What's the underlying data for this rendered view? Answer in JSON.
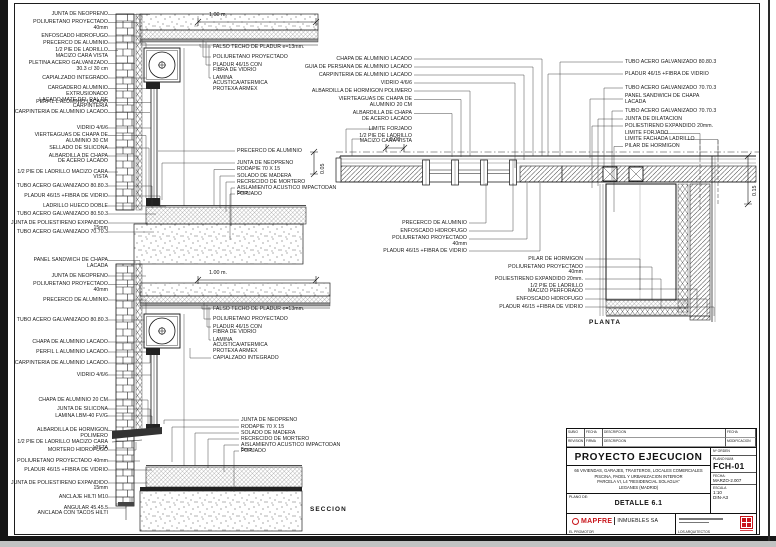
{
  "section": {
    "caption": "SECCION",
    "dim_top": "1.00 m.",
    "dim_mid": "1.00 m.",
    "dim_step": "0.05",
    "labels_a": [
      "JUNTA DE NEOPRENO",
      "POLIURETANO PROYECTADO\n40mm",
      "ENFOSCADO HIDROFUGO",
      "PRECERCO DE ALUMINIO",
      "1/2 PIE DE LADRILLO\nMACIZO CARA VISTA",
      "PLETINA ACERO GALVANIZADO\n30.3 c/ 30 cm",
      "CAPIALZADO INTEGRADO",
      "CARGADERO ALUMINIO EXTRUSIONADO\nLACADO MATE DEL RAL DE CARPINTERIA",
      "PERFIL L ALUMINIO LACADO",
      "CARPINTERIA DE ALUMINIO LACADO"
    ],
    "labels_b": [
      "VIDRIO 4/6/6",
      "VIERTEAGUAS DE CHAPA DE\nALUMINIO 30 CM",
      "SELLADO DE SILICONA",
      "ALBARDILLA DE CHAPA\nDE ACERO LACADO",
      "1/2 PIE DE LADRILLO MACIZO CARA VISTA",
      "TUBO ACERO GALVANIZADO 80.80.3",
      "PLADUR 46/15 +FIBRA DE VIDRIO",
      "LADRILLO HUECO DOBLE",
      "TUBO ACERO GALVANIZADO 80.50.3",
      "JUNTA DE POLIESTIRENO EXPANDIDO 15mm",
      "TUBO ACERO GALVANIZADO 70.70.3"
    ],
    "labels_c": [
      "PANEL SANDWICH DE CHAPA\nLACADA",
      "JUNTA DE NEOPRENO",
      "POLIURETANO PROYECTADO\n40mm",
      "PRECERCO DE ALUMINIO",
      "TUBO ACERO GALVANIZADO 80.80.3",
      "CHAPA DE ALUMINIO LACADO",
      "PERFIL L ALUMINIO LACADO",
      "CARPINTERIA DE ALUMINIO LACADO",
      "VIDRIO 4/6/6"
    ],
    "labels_d": [
      "CHAPA DE ALUMINIO 20 CM",
      "JUNTA DE SILICONA",
      "LAMINA LBM-40 FV/G",
      "ALBARDILLA DE HORMIGON POLIMERO\n1/2 PIE DE LADRILLO MACIZO CARA VISTA",
      "MORTERO HIDROFUGO",
      "POLIURETANO PROYECTADO 40mm",
      "PLADUR 46/15 +FIBRA DE VIDRIO",
      "JUNTA DE POLIESTIRENO EXPANDIDO 15mm",
      "ANCLAJE HILTI M10",
      "ANGULAR 45.45.5\nANCLADA CON TACOS HILTI"
    ],
    "labels_ceiling1": [
      "FALSO TECHO DE PLADUR e=13mm.",
      "POLIURETANO PROYECTADO",
      "PLADUR 46/15 CON\nFIBRA DE VIDRIO",
      "LAMINA\nACUSTICA/ATERMICA\nPROTEXA ARMEX"
    ],
    "labels_floor1": [
      "PRECERCO DE ALUMINIO",
      "JUNTA DE NEOPRENO",
      "RODAPIE 70 X 15",
      "SOLADO DE MADERA",
      "RECRECIDO DE MORTERO",
      "AISLAMIENTO ACUSTICO IMPACTODAN 5mm",
      "FORJADO"
    ],
    "labels_ceiling2": [
      "FALSO TECHO DE PLADUR e=13mm.",
      "POLIURETANO PROYECTADO",
      "PLADUR 46/15 CON\nFIBRA DE VIDRIO",
      "LAMINA\nACUSTICA/ATERMICA\nPROTEXA ARMEX",
      "CAPIALZADO INTEGRADO"
    ],
    "labels_floor2": [
      "JUNTA DE NEOPRENO",
      "RODAPIE 70 X 15",
      "SOLADO DE MADERA",
      "RECRECIDO DE MORTERO",
      "AISLAMIENTO ACUSTICO IMPACTODAN 5mm",
      "FORJADO"
    ]
  },
  "plan": {
    "caption": "PLANTA",
    "dim_offset": "0.08",
    "dim_thickness": "0.15",
    "labels_left": [
      "CHAPA DE ALUMINIO LACADO",
      "GUIA DE PERSIANA DE ALUMINIO LACADO",
      "CARPINTERIA DE ALUMINIO LACADO",
      "VIDRIO 4/6/6",
      "ALBARDILLA DE HORMIGON POLIMERO",
      "VIERTEAGUAS DE CHAPA DE\nALUMINIO 20 CM",
      "ALBARDILLA DE CHAPA\nDE ACERO LACADO",
      "LIMITE FORJADO",
      "1/2 PIE DE LADRILLO\nMACIZO CARA VISTA"
    ],
    "labels_right": [
      "TUBO ACERO GALVANIZADO 80.80.3",
      "PLADUR 46/15 +FIBRA DE VIDRIO",
      "TUBO ACERO GALVANIZADO 70.70.3",
      "PANEL SANDWICH DE CHAPA\nLACADA",
      "TUBO ACERO GALVANIZADO 70.70.3",
      "JUNTA DE DILATACION",
      "POLIESTIRENO EXPANDIDO 20mm.",
      "LIMITE FORJADO",
      "LIMITE FACHADA LADRILLO",
      "PILAR DE HORMIGON"
    ],
    "labels_bottom_left": [
      "PRECERCO DE ALUMINIO",
      "ENFOSCADO HIDROFUGO",
      "POLIURETANO PROYECTADO\n40mm",
      "PLADUR 46/15 +FIBRA DE VIDRIO"
    ],
    "labels_bottom_right": [
      "PILAR DE HORMIGON",
      "POLIURETANO PROYECTADO\n40mm",
      "POLIESTIRENO EXPANDIDO 20mm.",
      "1/2 PIE DE LADRILLO\nMACIZO PERFORADO",
      "ENFOSCADO HIDROFUGO",
      "PLADUR 46/15 +FIBRA DE VIDRIO"
    ]
  },
  "titleblock": {
    "rev_r1c1": "SUBIO",
    "rev_r1c2": "FECHA",
    "rev_r1c3": "DESCRIPCION",
    "rev_r1c4": "FECHA",
    "rev_r2c1": "REVISION",
    "rev_r2c2": "FIRMA",
    "rev_r2c3": "DESCRIPCION",
    "rev_r2c4": "MODIFICACION",
    "project_title": "PROYECTO EJECUCION",
    "desc_line1": "66 VIVIENDAS, GARAJES, TRASTEROS, LOCALES COMERCIALES",
    "desc_line2": "PISCINA, PADEL Y URBANIZACION INTERIOR",
    "desc_line3": "PARCELA VI, L4 \"RESIDENCIAL SOLAGUA\"",
    "desc_line4": "LEGANES (MADRID)",
    "plano_de_label": "PLANO DE:",
    "drawing_title": "DETALLE 6.1",
    "orden_label": "Nº ORDEN",
    "num_label": "PLANO NUM.",
    "num_value": "FCH-01",
    "fecha_label": "FECHA:",
    "fecha_value": "MARZO-2.007",
    "escala_label": "ESCALA",
    "escala_value": "1:10",
    "formato": "DIN-A3",
    "promoter_brand": "MAPFRE",
    "promoter_suffix": "INMUEBLES SA",
    "promoter_caption": "EL PROMOTOR",
    "architects_caption": "LOS ARQUITECTOS",
    "brand_red": "#c8151b"
  }
}
